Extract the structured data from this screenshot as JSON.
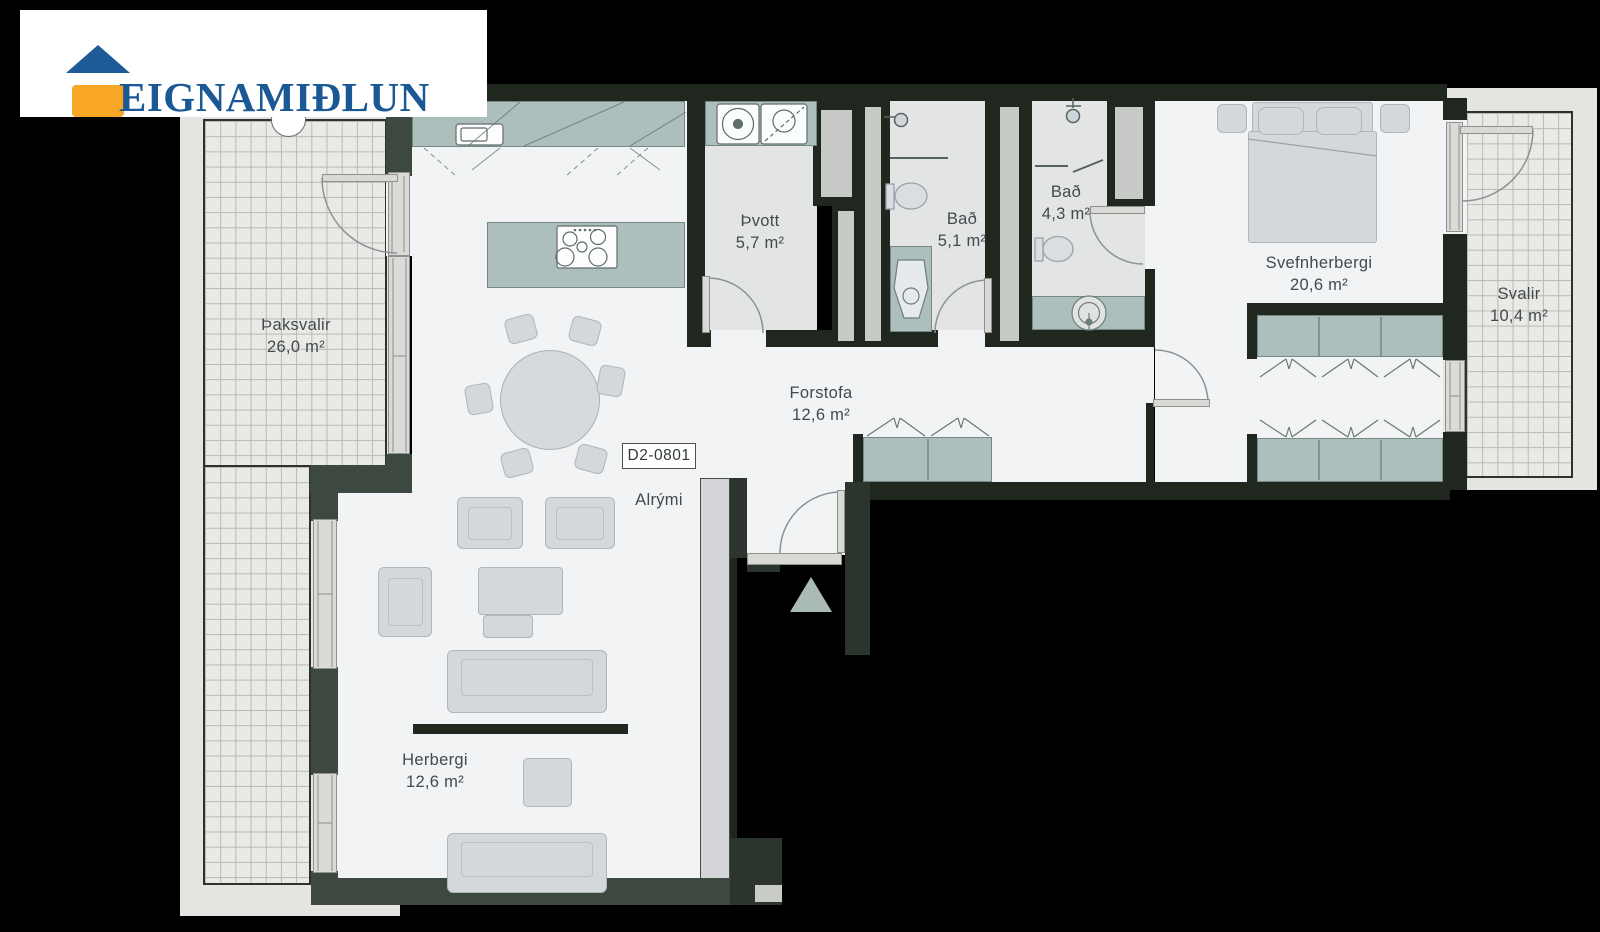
{
  "logo": {
    "text": "EIGNAMIÐLUN"
  },
  "unit": {
    "label": "D2-0801"
  },
  "rooms": [
    {
      "id": "thaksvalir",
      "name": "Þaksvalir",
      "area": "26,0 m²"
    },
    {
      "id": "thvott",
      "name": "Þvott",
      "area": "5,7 m²"
    },
    {
      "id": "bad-large",
      "name": "Bað",
      "area": "5,1 m²"
    },
    {
      "id": "bad-small",
      "name": "Bað",
      "area": "4,3 m²"
    },
    {
      "id": "svefnherbergi",
      "name": "Svefnherbergi",
      "area": "20,6 m²"
    },
    {
      "id": "svalir",
      "name": "Svalir",
      "area": "10,4 m²"
    },
    {
      "id": "forstofa",
      "name": "Forstofa",
      "area": "12,6 m²"
    },
    {
      "id": "alrymi",
      "name": "Alrými",
      "area": ""
    },
    {
      "id": "herbergi",
      "name": "Herbergi",
      "area": "12,6 m²"
    }
  ],
  "palette": {
    "wall_dark": "#20271f",
    "wall_outer": "#3d4840",
    "floor_white": "#f1f3f5",
    "floor_wet": "#e3e5e4",
    "terrace_slab": "#e4e4e1",
    "cabinet_teal": "#adbfbc",
    "furniture_gray": "#d4d8db",
    "logo_blue": "#1b5896",
    "logo_orange": "#f7a725",
    "background": "#000000"
  }
}
